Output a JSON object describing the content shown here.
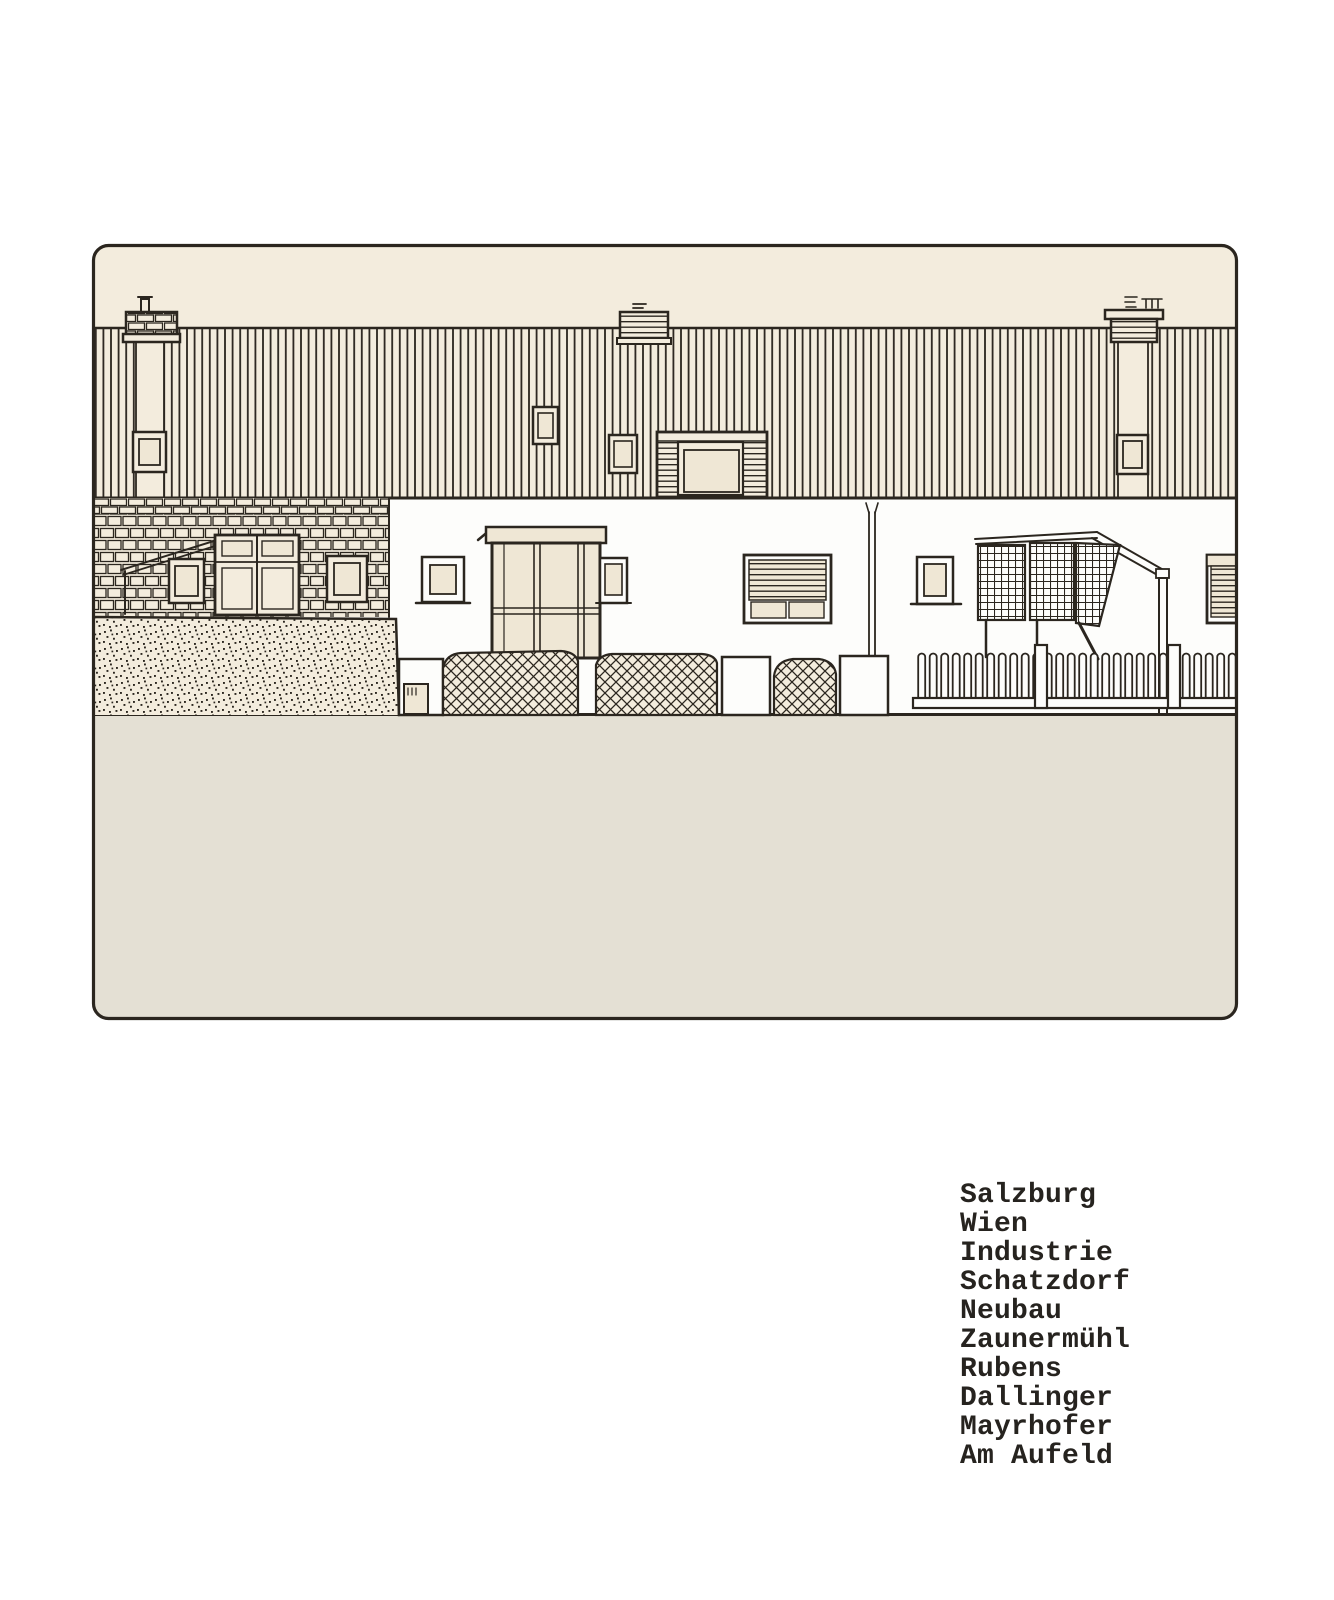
{
  "colors": {
    "ink": "#2b261f",
    "cream": "#f3ecdd",
    "pane": "#efe7d5",
    "facade": "#fdfdfb",
    "ground": "#e4e0d4",
    "paper": "#ffffff",
    "text": "#26231f"
  },
  "caption": {
    "lines": [
      "Salzburg",
      "Wien",
      "Industrie",
      "Schatzdorf",
      "Neubau",
      "Zaunermühl",
      "Rubens",
      "Dallinger",
      "Mayrhofer",
      "Am Aufeld"
    ]
  }
}
